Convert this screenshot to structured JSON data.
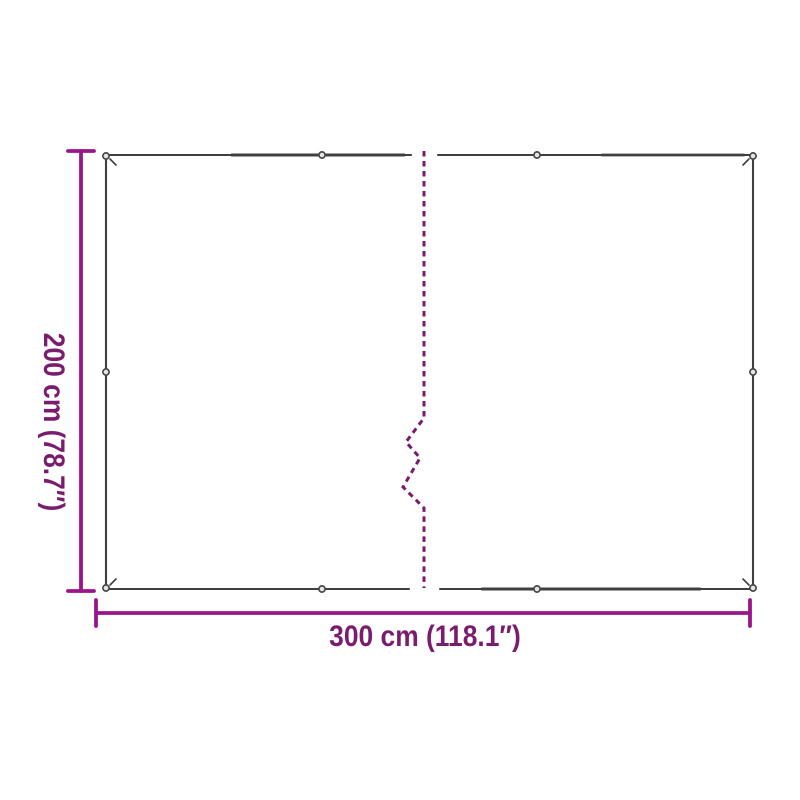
{
  "diagram": {
    "type": "product-dimension-diagram",
    "subject": "tarpaulin with eyelets and center fold line, two equal panels",
    "eyelet_count": 10
  },
  "dimensions": {
    "width": {
      "label": "300 cm (118.1″)",
      "cm": 300,
      "inches": 118.1
    },
    "height": {
      "label": "200 cm (78.7″)",
      "cm": 200,
      "inches": 78.7
    }
  },
  "colors": {
    "dimension_line": "#9b158a",
    "dimension_text": "#7b1d6f",
    "outline": "#3f3f3f",
    "fold_line": "#7a1a6e",
    "eyelet_fill": "#e6e6e6",
    "eyelet_ring": "#474747",
    "background": "#ffffff"
  }
}
